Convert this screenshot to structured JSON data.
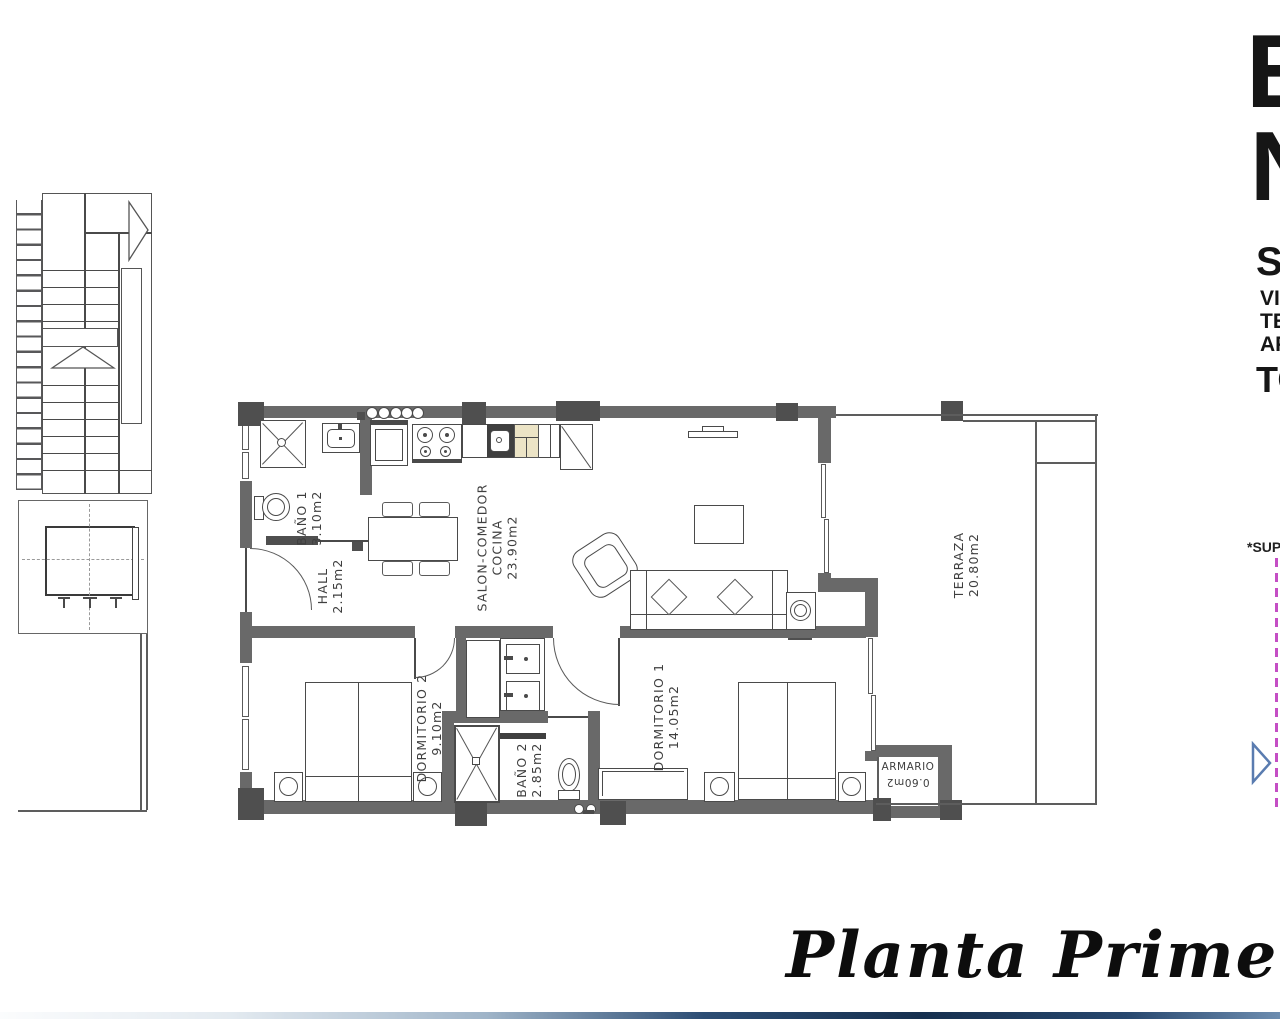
{
  "title": "Planta Primera",
  "rooms": {
    "bano1": {
      "name": "BAÑO 1",
      "area": "3.10m2"
    },
    "hall": {
      "name": "HALL",
      "area": "2.15m2"
    },
    "salon": {
      "line1": "SALON-COMEDOR",
      "line2": "COCINA",
      "area": "23.90m2"
    },
    "dormitorio2": {
      "name": "DORMITORIO 2",
      "area": "9.10m2"
    },
    "dormitorio1": {
      "name": "DORMITORIO 1",
      "area": "14.05m2"
    },
    "bano2": {
      "name": "BAÑO 2",
      "area": "2.85m2"
    },
    "armario": {
      "name": "ARMARIO",
      "area": "0.60m2"
    },
    "terraza": {
      "name": "TERRAZA",
      "area": "20.80m2"
    }
  },
  "edge_text": {
    "big1": "E",
    "big2": "N",
    "mid1": "SU",
    "small1": "VI",
    "small2": "TE",
    "small3": "AP",
    "mid2": "TO",
    "note": "*SUP"
  },
  "colors": {
    "wall": "#696969",
    "pillar": "#4f4f4f",
    "line": "#4a4a4a",
    "accent_pink": "#c44ec4",
    "accent_blue": "#5a7cb0",
    "bar_navy": "#16304f",
    "appliance_cream": "#ece4c6"
  }
}
